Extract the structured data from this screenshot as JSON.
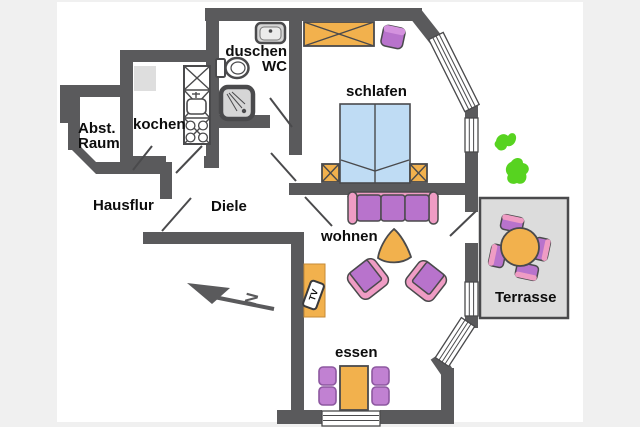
{
  "image": {
    "type": "apartment-floor-plan",
    "width": 640,
    "height": 427
  },
  "colors": {
    "page": "#f0f0f0",
    "canvas": "#ffffff",
    "wall": "#5a5a5c",
    "line": "#4a4a4c",
    "orange": "#f2b14d",
    "purple": "#b873cc",
    "purple-light": "#c181d2",
    "pink": "#ef9cc4",
    "blue": "#bfdcf4",
    "green": "#57d320",
    "terrace": "#dcdcdc",
    "fixture": "#d6d6d6"
  },
  "labels": {
    "storage": "Abst.\nRaum",
    "kitchen": "kochen",
    "bath": "duschen\nWC",
    "bedroom": "schlafen",
    "hall_outer": "Hausflur",
    "hall": "Diele",
    "living": "wohnen",
    "dining": "essen",
    "terrace": "Terrasse",
    "tv": "TV",
    "compass": "N"
  },
  "rooms": [
    {
      "name": "Abst. Raum",
      "furniture": []
    },
    {
      "name": "kochen",
      "furniture": [
        "refrigerator",
        "cabinet",
        "sink",
        "stove-4-burners"
      ]
    },
    {
      "name": "duschen WC",
      "furniture": [
        "washbasin",
        "toilet",
        "shower"
      ]
    },
    {
      "name": "schlafen",
      "furniture": [
        "wardrobe",
        "stool",
        "double-bed",
        "nightstand",
        "nightstand"
      ]
    },
    {
      "name": "Hausflur",
      "furniture": []
    },
    {
      "name": "Diele",
      "furniture": []
    },
    {
      "name": "wohnen",
      "furniture": [
        "sofa-3-seat",
        "coffee-table",
        "armchair",
        "armchair",
        "tv-board",
        "tv"
      ]
    },
    {
      "name": "essen",
      "furniture": [
        "dining-table",
        "chair",
        "chair",
        "chair",
        "chair"
      ]
    },
    {
      "name": "Terrasse",
      "furniture": [
        "round-table",
        "chair",
        "chair",
        "chair",
        "chair"
      ]
    }
  ],
  "symbols": [
    "north-arrow",
    "plant"
  ]
}
